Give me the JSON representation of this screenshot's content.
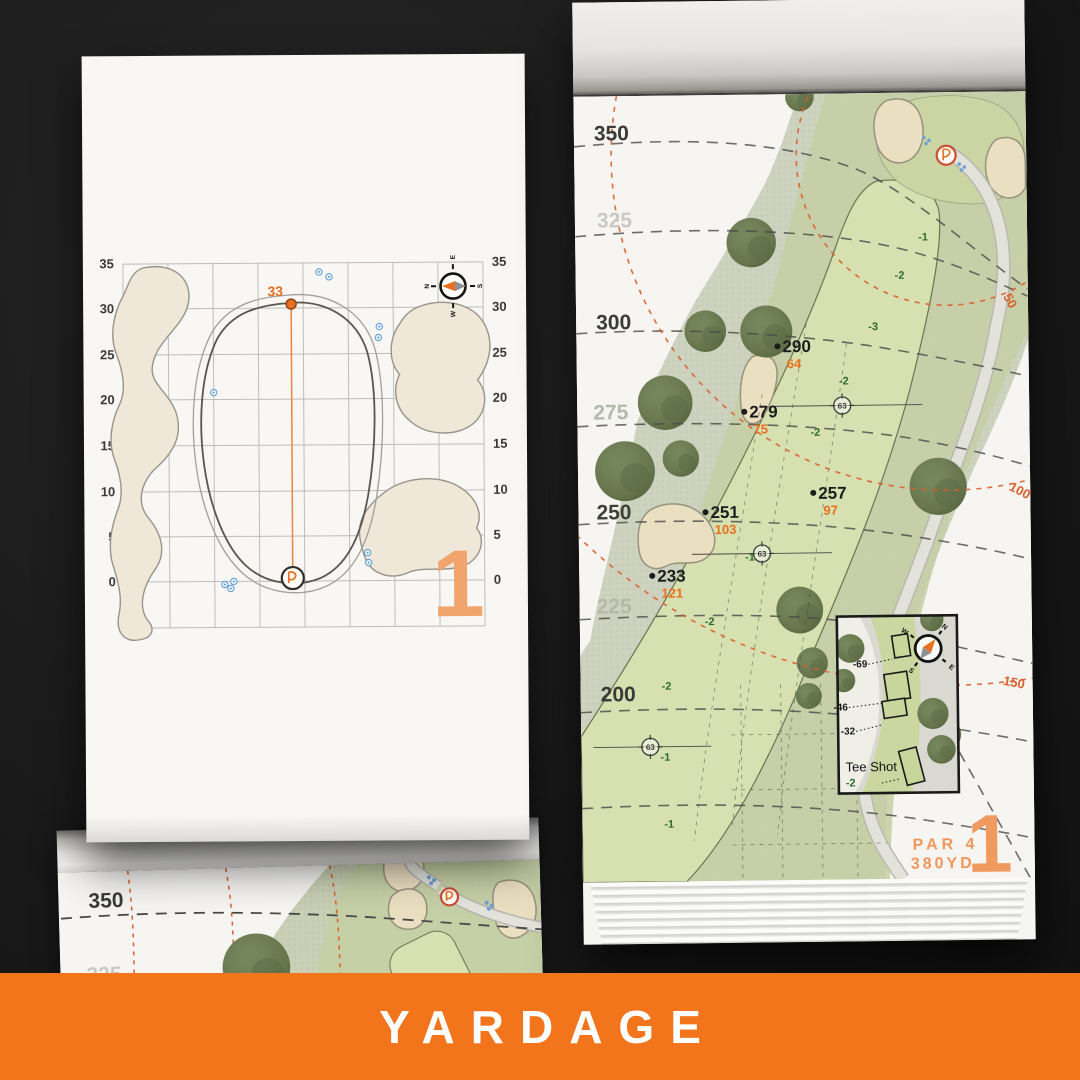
{
  "banner": {
    "label": "YARDAGE",
    "bg": "#F2741B",
    "text_color": "#FFFFFF"
  },
  "colors": {
    "accent_orange": "#E8701E",
    "soft_orange": "#F2A46F",
    "arc_orange": "#D95F2B",
    "elevation_green": "#2E6B2E",
    "sand": "#EBDFC2",
    "fairway": "#C5CFA3",
    "corridor": "#D4DEAF",
    "rough": "#CDD2BF",
    "tree": "#66754C",
    "sprinkler_blue": "#5B9BD5",
    "label_dark": "#3A3A38",
    "label_light": "#C9C9C4"
  },
  "compass": {
    "n": "N",
    "e": "E",
    "s": "S",
    "w": "W"
  },
  "left_page": {
    "hole_number": "1",
    "pin_distance": "33",
    "axis_ticks": [
      "35",
      "30",
      "25",
      "20",
      "15",
      "10",
      "5",
      "0"
    ]
  },
  "right_page": {
    "hole_number": "1",
    "par": "PAR 4",
    "yardage": "380YD",
    "distance_band_labels": [
      "350",
      "325",
      "300",
      "275",
      "250",
      "225",
      "200"
    ],
    "arc_labels": [
      "50",
      "100",
      "150"
    ],
    "waypoint": "63",
    "markers": [
      {
        "tee_yards": "290",
        "pin_yards": "64"
      },
      {
        "tee_yards": "279",
        "pin_yards": "75"
      },
      {
        "tee_yards": "257",
        "pin_yards": "97"
      },
      {
        "tee_yards": "251",
        "pin_yards": "103"
      },
      {
        "tee_yards": "233",
        "pin_yards": "121"
      }
    ],
    "elevations": [
      "-1",
      "-2",
      "-3",
      "-2",
      "-2",
      "-1",
      "-2",
      "-2",
      "-1",
      "-1"
    ],
    "inset": {
      "title": "Tee Shot",
      "elevation": "-2",
      "tee_offsets": [
        "-69",
        "-46",
        "-32"
      ]
    }
  },
  "bottom_page": {
    "distance_band_labels": [
      "350",
      "325"
    ]
  }
}
